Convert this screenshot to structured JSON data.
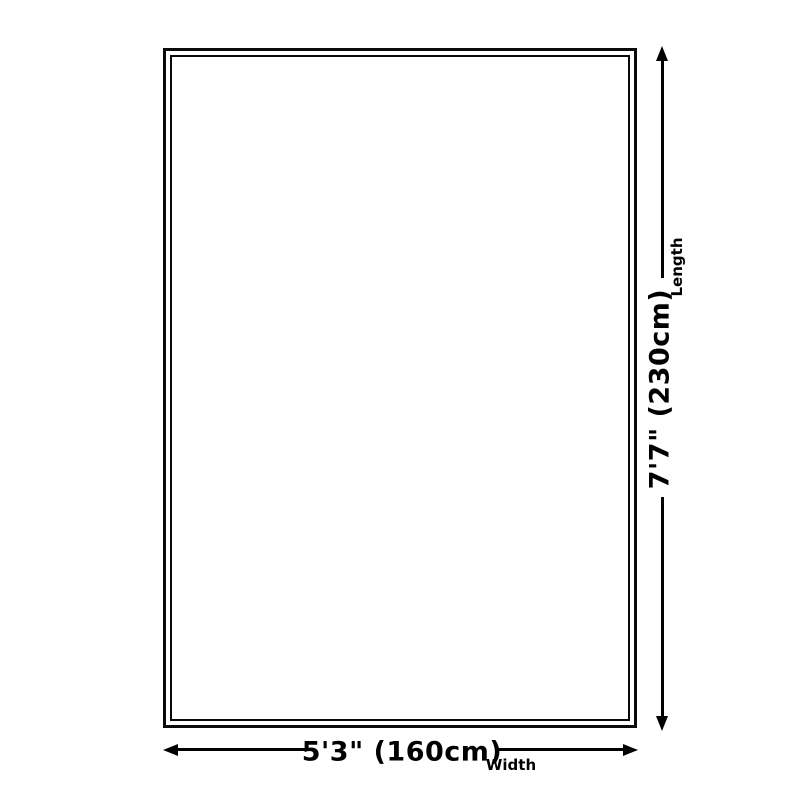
{
  "diagram": {
    "type": "product-dimension-diagram",
    "shape": "rectangle",
    "background_color": "#ffffff",
    "line_color": "#000000",
    "width_dimension": {
      "value": "5'3\" (160cm)",
      "label": "Width"
    },
    "length_dimension": {
      "value": "7'7\" (230cm)",
      "label": "Length"
    }
  }
}
